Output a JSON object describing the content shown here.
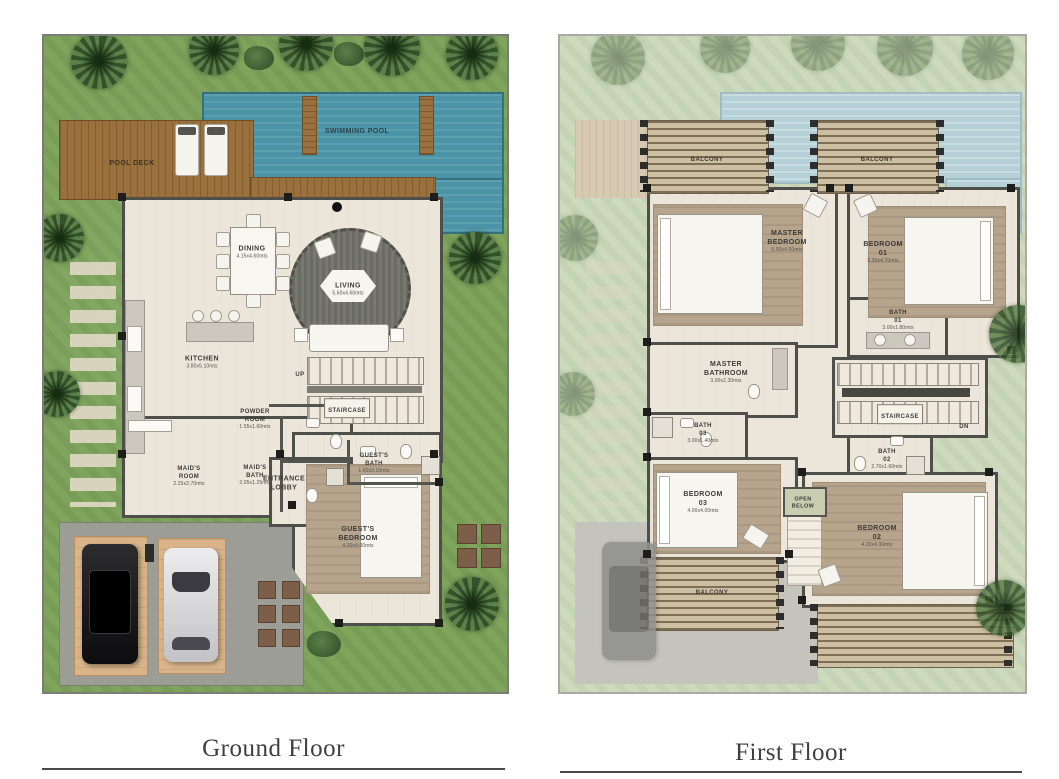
{
  "captions": {
    "ground": "Ground Floor",
    "first": "First Floor"
  },
  "colors": {
    "grass": "#7fa45c",
    "grass_faded": "#cddabd",
    "pool": "#4b93a6",
    "pool_faded": "#b6d0d7",
    "deck": "#9a713d",
    "wall": "#4e4e4a",
    "floor": "#ece6da",
    "carpet": "#b6a48d",
    "driveway": "#9d9d98",
    "paving": "#d9b489"
  },
  "ground": {
    "outdoor": {
      "swimming_pool": "SWIMMING POOL",
      "pool_deck": "POOL DECK"
    },
    "rooms": {
      "dining": {
        "name": "DINING",
        "dims": "4.15x4.60mts"
      },
      "living": {
        "name": "LIVING",
        "dims": "5.60x4.60mts"
      },
      "kitchen": {
        "name": "KITCHEN",
        "dims": "3.80x5.10mts"
      },
      "up": {
        "name": "UP"
      },
      "staircase": {
        "name": "STAIRCASE"
      },
      "powder": {
        "name": "POWDER\nROOM",
        "dims": "1.55x1.60mts"
      },
      "maids_room": {
        "name": "MAID'S\nROOM",
        "dims": "2.25x2.70mts"
      },
      "maids_bath": {
        "name": "MAID'S\nBATH",
        "dims": "2.05x1.25mts"
      },
      "lobby": {
        "name": "ENTRANCE\nLOBBY"
      },
      "guest_bath": {
        "name": "GUEST'S\nBATH",
        "dims": "1.60x3.10mts"
      },
      "guest_bedroom": {
        "name": "GUEST'S\nBEDROOM",
        "dims": "4.20x4.00mts"
      }
    }
  },
  "first": {
    "rooms": {
      "balcony_1": {
        "name": "BALCONY"
      },
      "balcony_2": {
        "name": "BALCONY"
      },
      "balcony_3": {
        "name": "BALCONY"
      },
      "master_bedroom": {
        "name": "MASTER\nBEDROOM",
        "dims": "5.00x4.60mts"
      },
      "bedroom_01": {
        "name": "BEDROOM\n01",
        "dims": "3.30x4.70mts"
      },
      "bath_01": {
        "name": "BATH\n01",
        "dims": "3.00x1.80mts"
      },
      "master_bathroom": {
        "name": "MASTER\nBATHROOM",
        "dims": "3.00x2.30mts"
      },
      "bath_03": {
        "name": "BATH\n03",
        "dims": "3.00x1.40mts"
      },
      "bath_02": {
        "name": "BATH\n02",
        "dims": "2.70x1.60mts"
      },
      "staircase": {
        "name": "STAIRCASE"
      },
      "dn": {
        "name": "DN"
      },
      "open_below": {
        "name": "OPEN\nBELOW"
      },
      "bedroom_03": {
        "name": "BEDROOM\n03",
        "dims": "4.00x4.00mts"
      },
      "bedroom_02": {
        "name": "BEDROOM\n02",
        "dims": "4.20x4.30mts"
      }
    }
  }
}
